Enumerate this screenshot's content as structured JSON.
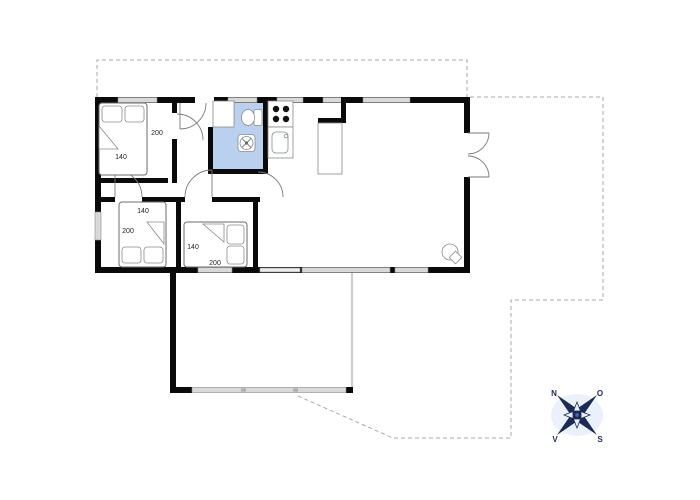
{
  "scene": {
    "kind": "floor-plan"
  },
  "colors": {
    "background": "#ffffff",
    "wall": "#0a0a0a",
    "bathroom_fill": "#b9d1ef",
    "window_fill": "#d9d9d9",
    "open_slider_fill": "#ededed",
    "boundary_dash": "#a8a8a8",
    "furniture_stroke": "#6b6b6b",
    "compass": "#1b2b57",
    "compass_halo": "#dbe6f5"
  },
  "bedrooms": {
    "bedroom1": {
      "bed_length": "200",
      "bed_width": "140"
    },
    "bedroom2": {
      "bed_length": "200",
      "bed_width": "140"
    },
    "bedroom3": {
      "bed_length": "200",
      "bed_width": "140"
    }
  },
  "compass": {
    "north": "N",
    "east": "O",
    "south": "S",
    "west": "V"
  }
}
